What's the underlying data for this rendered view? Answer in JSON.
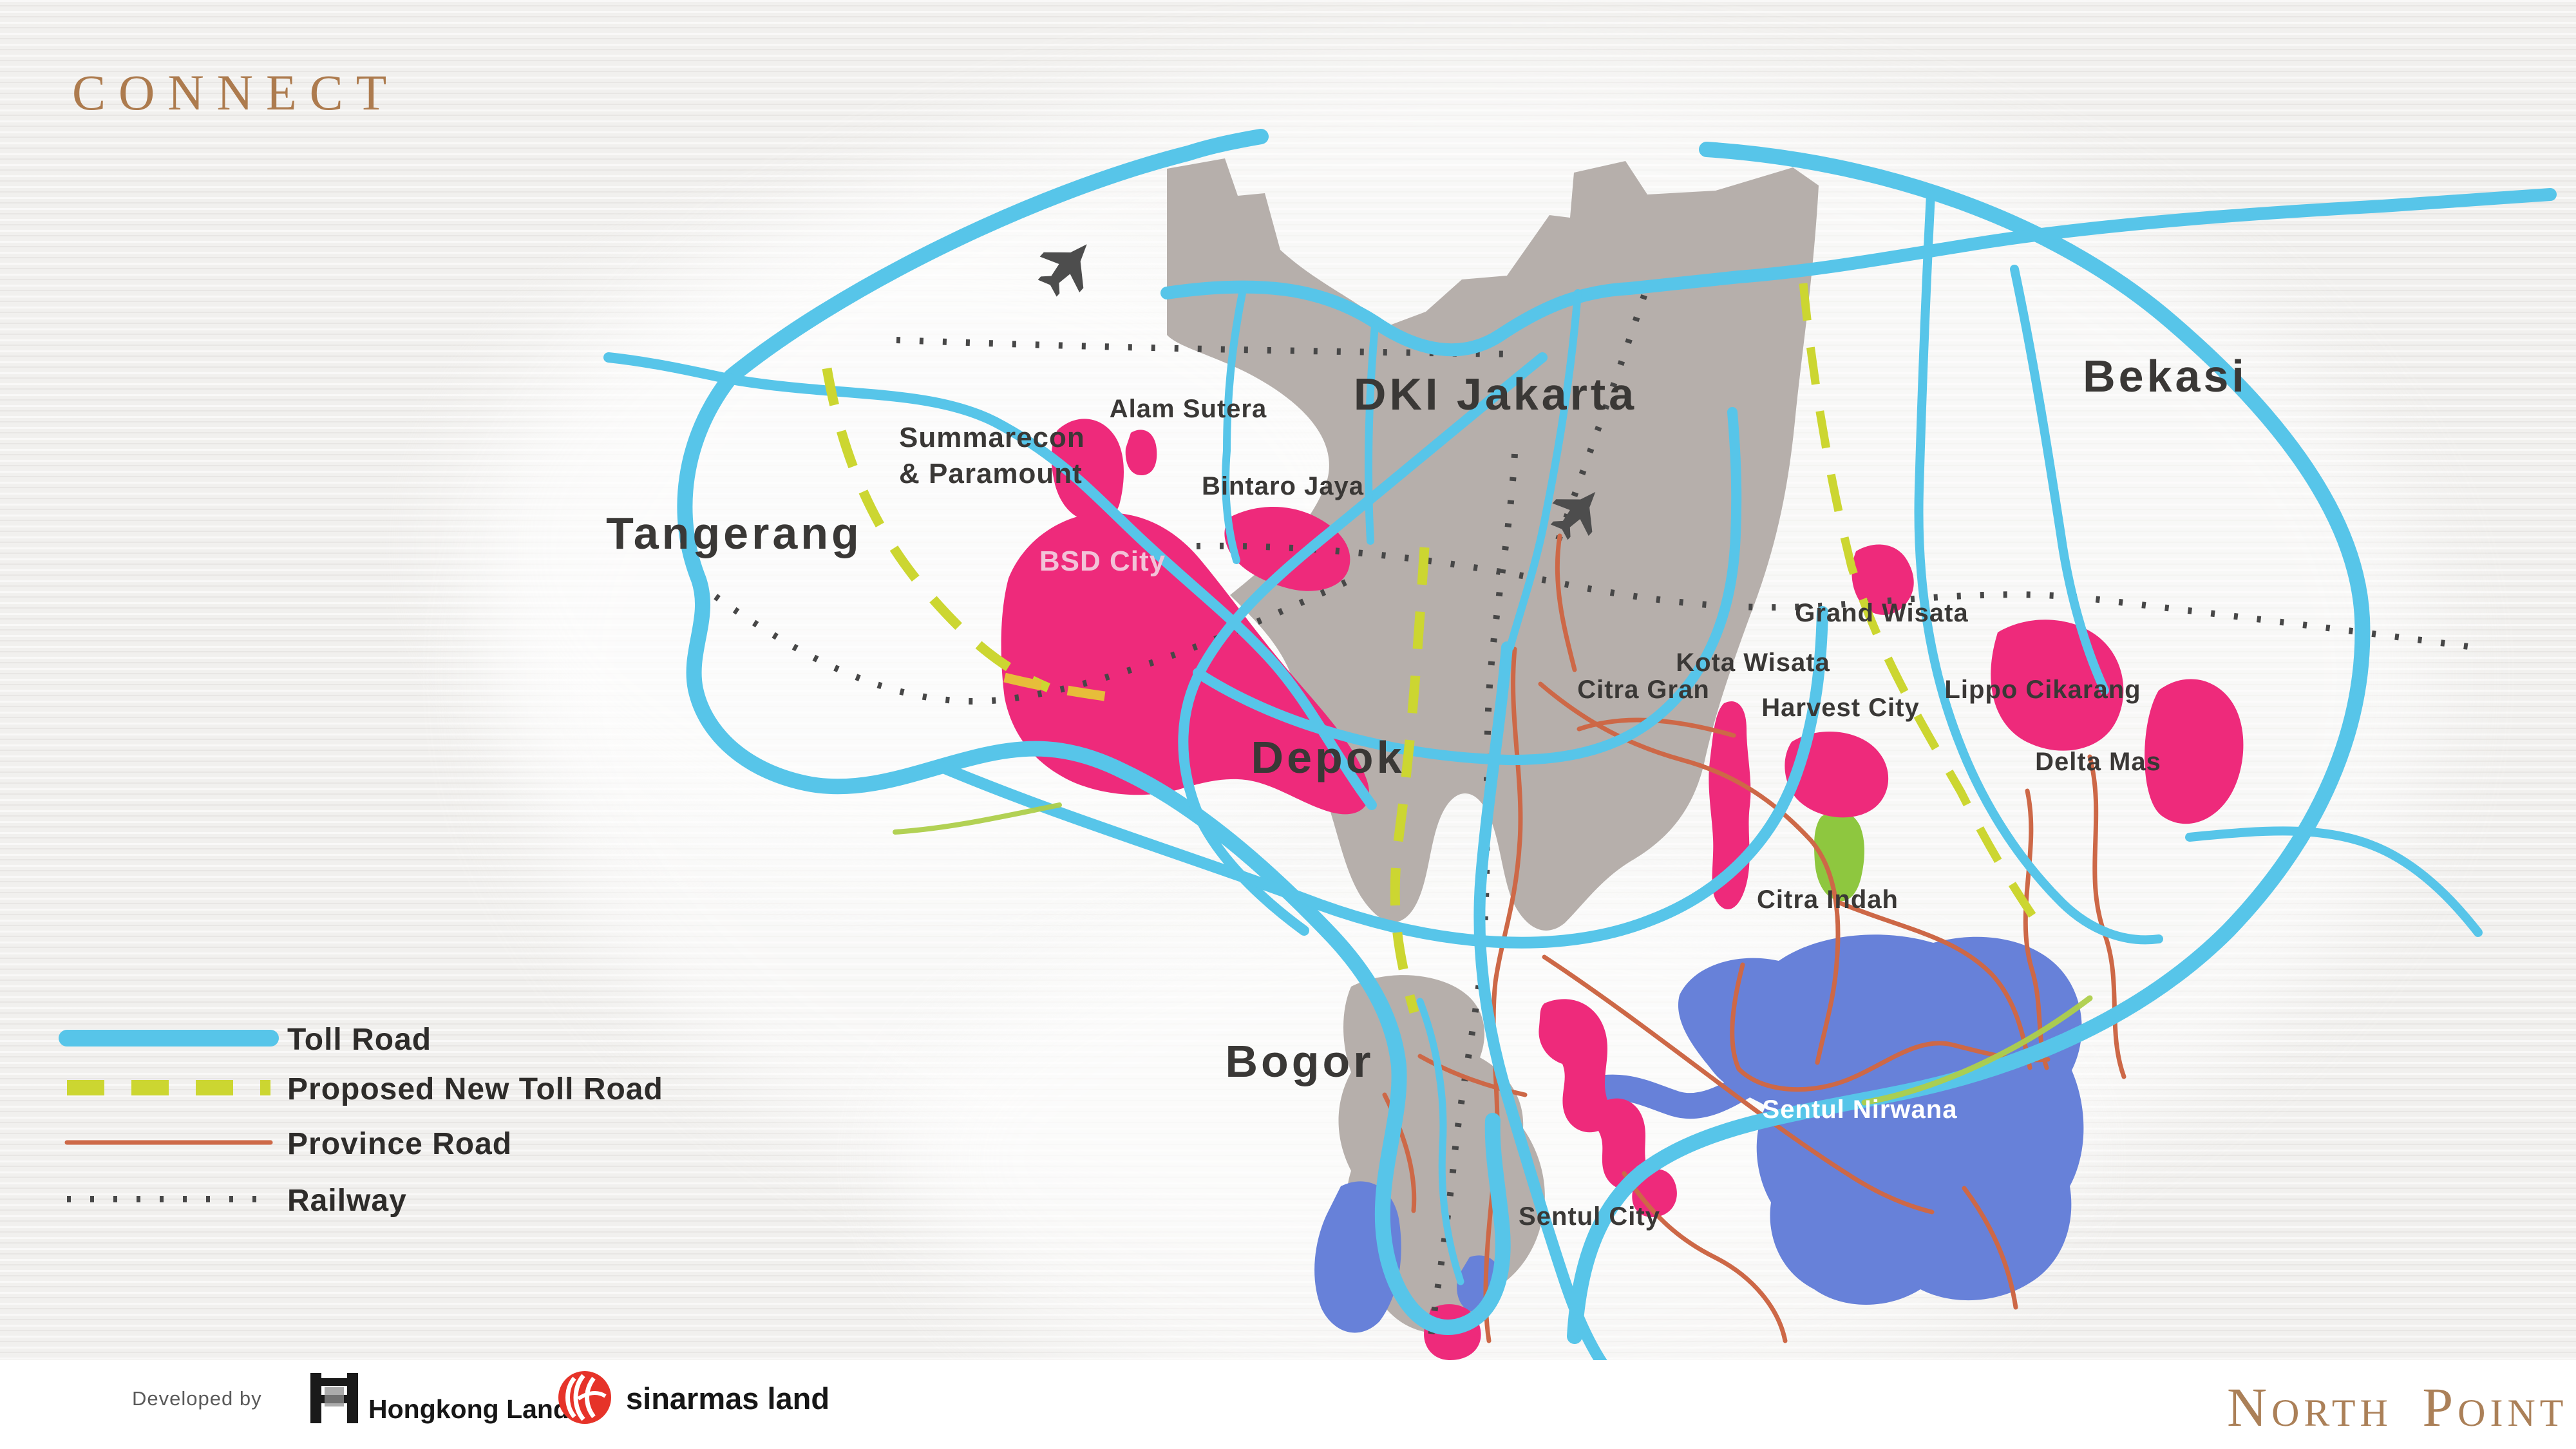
{
  "slide": {
    "title": "CONNECT"
  },
  "colors": {
    "background": "#f1f0ee",
    "accent_title": "#ad7b4e",
    "brand_brown": "#ab8058",
    "toll_road": "#57c5e9",
    "proposed_toll": "#ccd631",
    "proposed_toll_gold": "#e7bd3a",
    "province_road": "#cd6847",
    "railway": "#474747",
    "region_gray": "#b6afab",
    "township_pink": "#ee2a7b",
    "township_green": "#8ec73f",
    "township_blue": "#6781d9",
    "label_dark": "#3a3836",
    "bsd_label": "#f2c3d8"
  },
  "map": {
    "labels": [
      {
        "text": "Tangerang"
      },
      {
        "text": "DKI Jakarta"
      },
      {
        "text": "Bekasi"
      },
      {
        "text": "Depok"
      },
      {
        "text": "Bogor"
      },
      {
        "text": "Summarecon"
      },
      {
        "text": "& Paramount"
      },
      {
        "text": "Alam Sutera"
      },
      {
        "text": "Bintaro Jaya"
      },
      {
        "text": "BSD City"
      },
      {
        "text": "Grand Wisata"
      },
      {
        "text": "Kota Wisata"
      },
      {
        "text": "Citra Gran"
      },
      {
        "text": "Harvest City"
      },
      {
        "text": "Lippo Cikarang"
      },
      {
        "text": "Delta Mas"
      },
      {
        "text": "Citra Indah"
      },
      {
        "text": "Sentul Nirwana"
      },
      {
        "text": "Sentul City"
      }
    ],
    "icons": [
      {
        "name": "airport-soekarno-hatta"
      },
      {
        "name": "airport-halim"
      }
    ]
  },
  "legend": {
    "items": [
      {
        "label": "Toll Road"
      },
      {
        "label": "Proposed New Toll Road"
      },
      {
        "label": "Province Road"
      },
      {
        "label": "Railway"
      }
    ]
  },
  "footer": {
    "developed_by": "Developed by",
    "developer_1": "Hongkong Land",
    "developer_2": "sinarmas land",
    "brand": "North Point"
  }
}
